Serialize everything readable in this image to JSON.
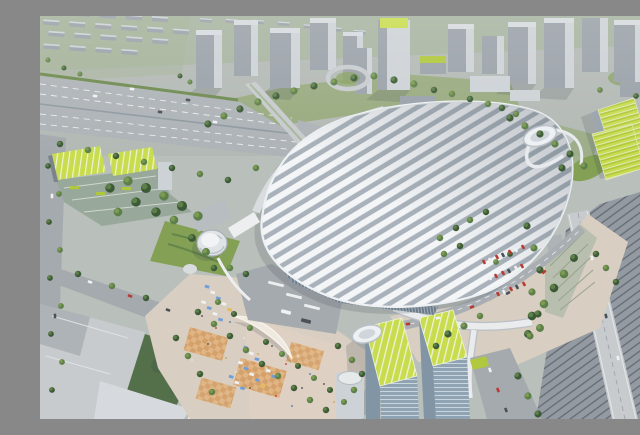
{
  "scene": {
    "subject": "Aerial architectural rendering of a large railway station complex with a white ribbed arched roof, surrounded by green-roofed towers, an expressway, rail tracks and a market plaza",
    "elements": [
      {
        "name": "main-station-roof",
        "note": "huge white roof of diagonal parallel ribs, rounded oblong plan, glazed band along its south-west edge"
      },
      {
        "name": "roof-oval-pod-east",
        "note": "white oval ring pavilion at the north-east roof corner with curved ramps"
      },
      {
        "name": "roof-oval-pod-south",
        "note": "white oval ring pavilion at the south plaza edge"
      },
      {
        "name": "west-cylinder-pavilion",
        "note": "white stacked-cylinder tower at the station west entrance"
      },
      {
        "name": "green-roof-complex-west",
        "note": "terraced offices with bright chartreuse roofs and tree courtyard"
      },
      {
        "name": "green-striped-tower-northeast",
        "note": "bent slab tower with yellow-green striped roof planes"
      },
      {
        "name": "green-roof-twin-towers-south",
        "note": "two glass towers with bright green striped roofs"
      },
      {
        "name": "market-plaza-southwest",
        "note": "tan paved plaza with orange checker patches, striped stalls, leaf-shaped arch canopy, trees and pedestrians"
      },
      {
        "name": "expressway-west",
        "note": "multi-lane corridor entering from the left with overpass"
      },
      {
        "name": "rail-corridor-southeast",
        "note": "multiple tracks with a light grey viaduct crossing toward the bottom-right corner"
      },
      {
        "name": "cbd-towers-north",
        "note": "cluster of grey high-rise towers across the top"
      },
      {
        "name": "residential-blocks-northwest",
        "note": "rows of low grey housing slabs"
      },
      {
        "name": "parking-lot-east",
        "note": "diagonal rows of red and white cars on tan paving"
      },
      {
        "name": "park-band-north",
        "note": "lawns and street trees between the city and the station roof"
      },
      {
        "name": "big-box-roofs-southwest",
        "note": "large flat grey rooftops and a dark lawn"
      }
    ]
  },
  "palette": {
    "base": "#b9bfba",
    "city_ground": "#b3b9b4",
    "green_field": "#a3b196",
    "lawn": "#83a055",
    "lawn_dark": "#54704a",
    "tree_dark": "#3d5a37",
    "tree_mid": "#5d7f49",
    "tree_light": "#7b9a52",
    "bldg_gray": "#9aa1a8",
    "bldg_lit": "#cdd2d6",
    "bldg_dark": "#7b838b",
    "bldg_cap": "#d6dade",
    "roof_white": "#f3f5f7",
    "roof_gap": "#a9b2ba",
    "glass": "#8fa3b3",
    "glass_line": "#c9d6e0",
    "facade_dark": "#6d7b88",
    "facade_line": "#9fb0bd",
    "lime": "#c8dc4e",
    "lime_deep": "#b0c83d",
    "lime_seam": "#eef3d8",
    "road": "#aeb3b7",
    "road_light": "#c7cbce",
    "street": "#a5aaae",
    "track_bed": "#949aa1",
    "track_line": "#5f666e",
    "paving": "#d8cec1",
    "paving_pink": "#e3d3c6",
    "paving_accent": "#d2995c",
    "paving_accent2": "#e2b078",
    "canopy_white": "#eceeef",
    "car_red": "#b93a32",
    "car_white": "#eff1f2",
    "car_dark": "#4a5158",
    "stall_blue": "#6f9fd8",
    "stall_yellow": "#e4bc55",
    "shadow": "#2e3a42"
  }
}
